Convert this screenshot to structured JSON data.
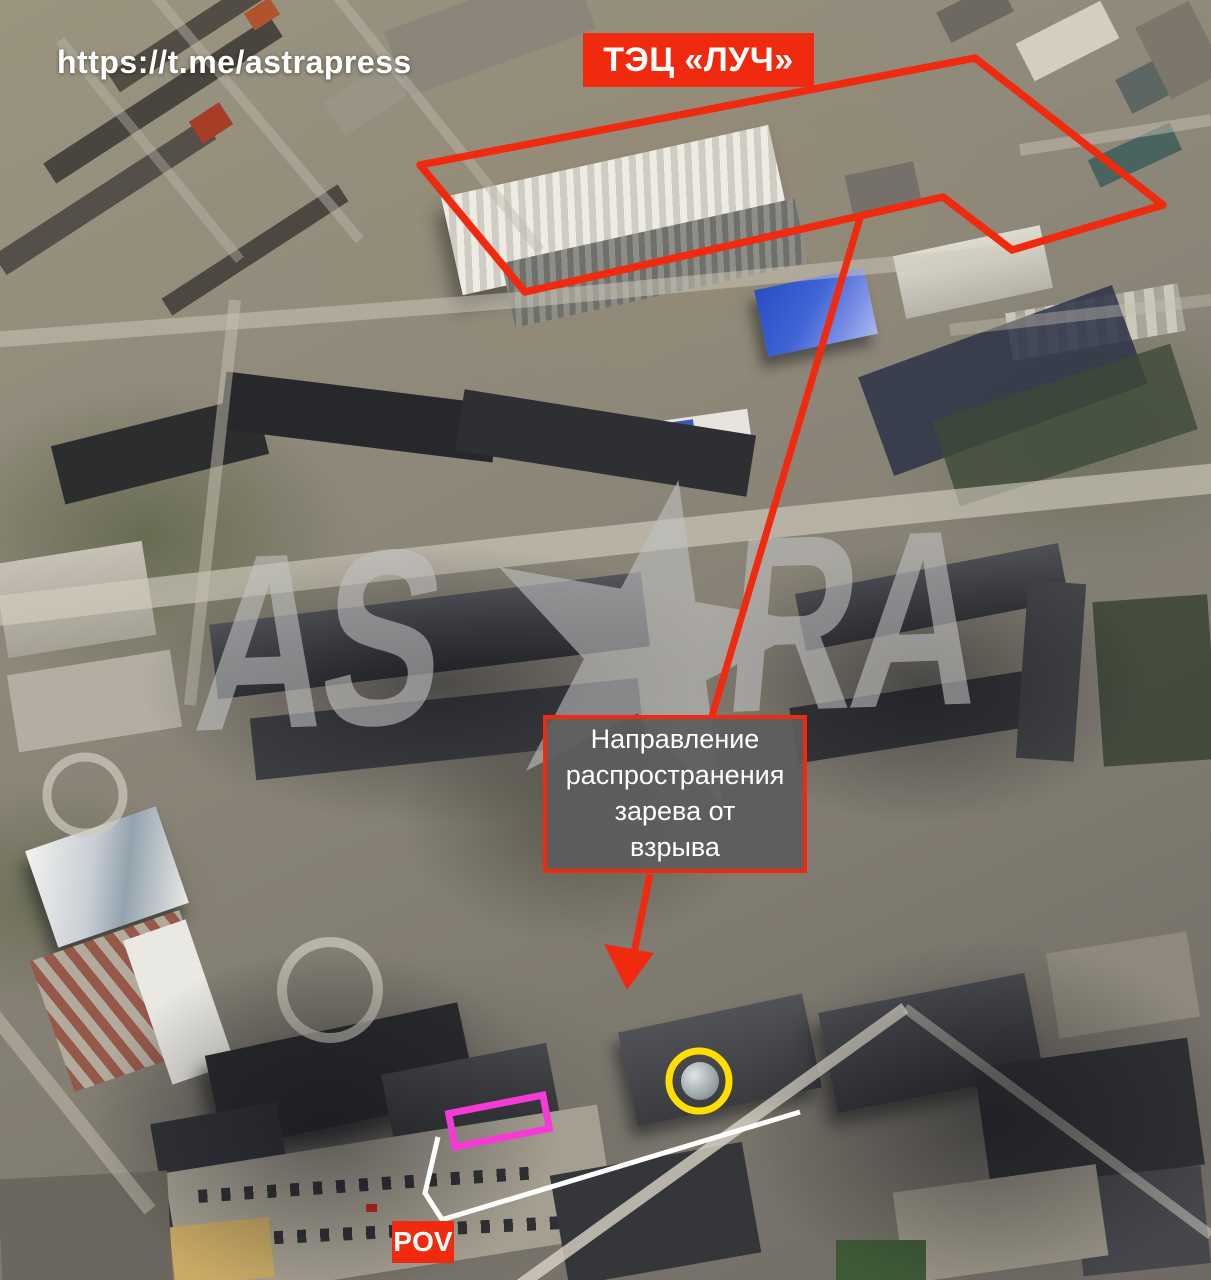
{
  "header": {
    "url": "https://t.me/astrapress"
  },
  "labels": {
    "plant": "ТЭЦ «ЛУЧ»",
    "direction_note": "Направление\nраспространения\nзарева от\nвзрыва",
    "pov": "POV"
  },
  "watermark": {
    "left": "AS",
    "right": "RA"
  },
  "colors": {
    "annotation-red": "#f02a0e",
    "highlight-yellow": "#ffdf00",
    "highlight-magenta": "#f53ad6",
    "sightline-white": "#ffffff",
    "note-box-gray": "#5c5c5e",
    "label-text": "#ffffff",
    "watermark-gray": "#c3c3c3"
  }
}
